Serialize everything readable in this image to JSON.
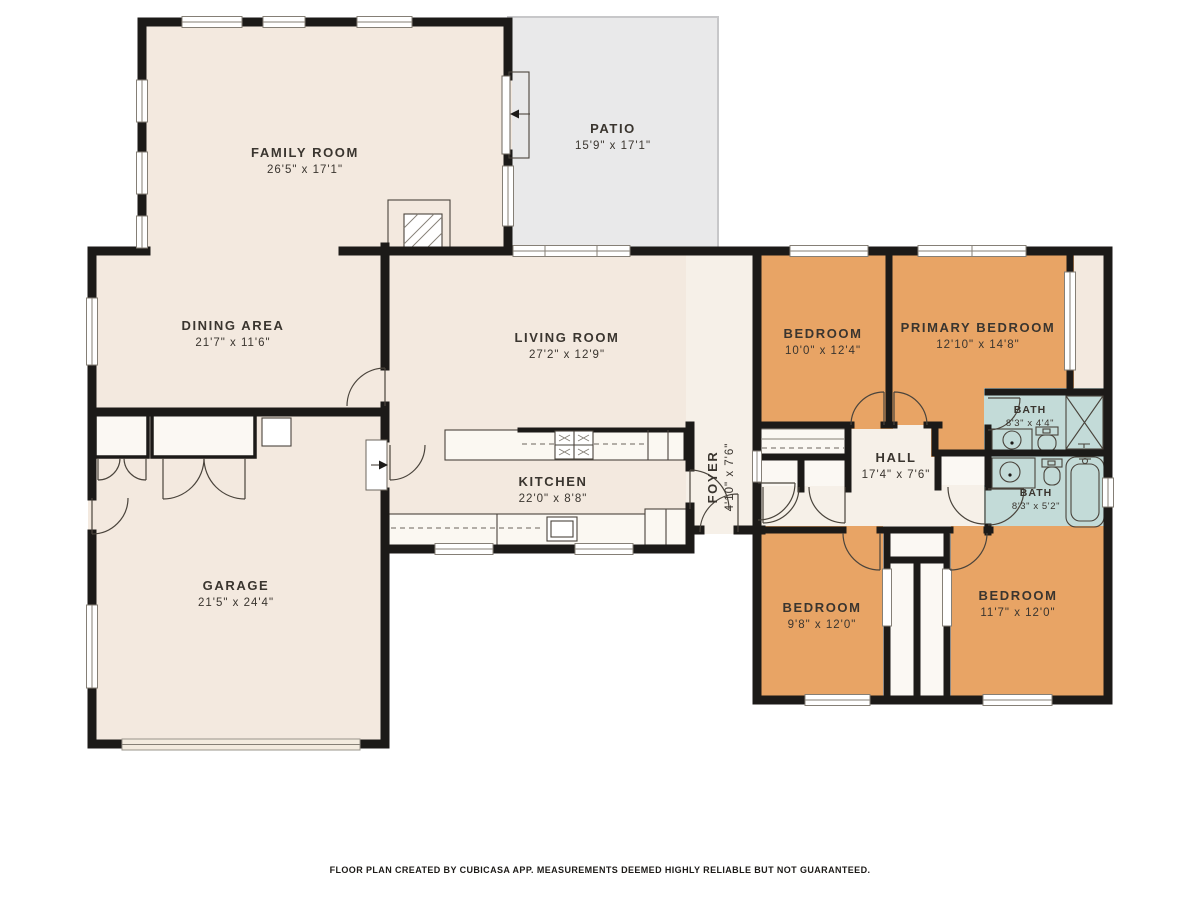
{
  "plan": {
    "footer": "FLOOR PLAN CREATED BY CUBICASA APP. MEASUREMENTS DEEMED HIGHLY RELIABLE BUT NOT GUARANTEED.",
    "rooms": [
      {
        "id": "family-room",
        "name": "FAMILY ROOM",
        "dims": "26'5\" x 17'1\""
      },
      {
        "id": "patio",
        "name": "PATIO",
        "dims": "15'9\" x 17'1\""
      },
      {
        "id": "dining-area",
        "name": "DINING AREA",
        "dims": "21'7\" x 11'6\""
      },
      {
        "id": "living-room",
        "name": "LIVING ROOM",
        "dims": "27'2\" x 12'9\""
      },
      {
        "id": "kitchen",
        "name": "KITCHEN",
        "dims": "22'0\" x 8'8\""
      },
      {
        "id": "foyer",
        "name": "FOYER",
        "dims": "4'10\" x 7'6\""
      },
      {
        "id": "garage",
        "name": "GARAGE",
        "dims": "21'5\" x 24'4\""
      },
      {
        "id": "bedroom-1",
        "name": "BEDROOM",
        "dims": "10'0\" x 12'4\""
      },
      {
        "id": "primary-bedroom",
        "name": "PRIMARY BEDROOM",
        "dims": "12'10\" x 14'8\""
      },
      {
        "id": "bath-1",
        "name": "BATH",
        "dims": "8'3\" x 4'4\""
      },
      {
        "id": "hall",
        "name": "HALL",
        "dims": "17'4\" x 7'6\""
      },
      {
        "id": "bath-2",
        "name": "BATH",
        "dims": "8'3\" x 5'2\""
      },
      {
        "id": "bedroom-2",
        "name": "BEDROOM",
        "dims": "9'8\" x 12'0\""
      },
      {
        "id": "bedroom-3",
        "name": "BEDROOM",
        "dims": "11'7\" x 12'0\""
      }
    ],
    "colors": {
      "room_fill": "#f3e9df",
      "bedroom_fill": "#e8a465",
      "bath_fill": "#c3dbd8",
      "patio_fill": "#e9e9ea",
      "hall_fill": "#f6f0e8",
      "closet_fill": "#fbf8f3",
      "wall": "#1c1a18",
      "label_text": "#3a352f"
    }
  }
}
